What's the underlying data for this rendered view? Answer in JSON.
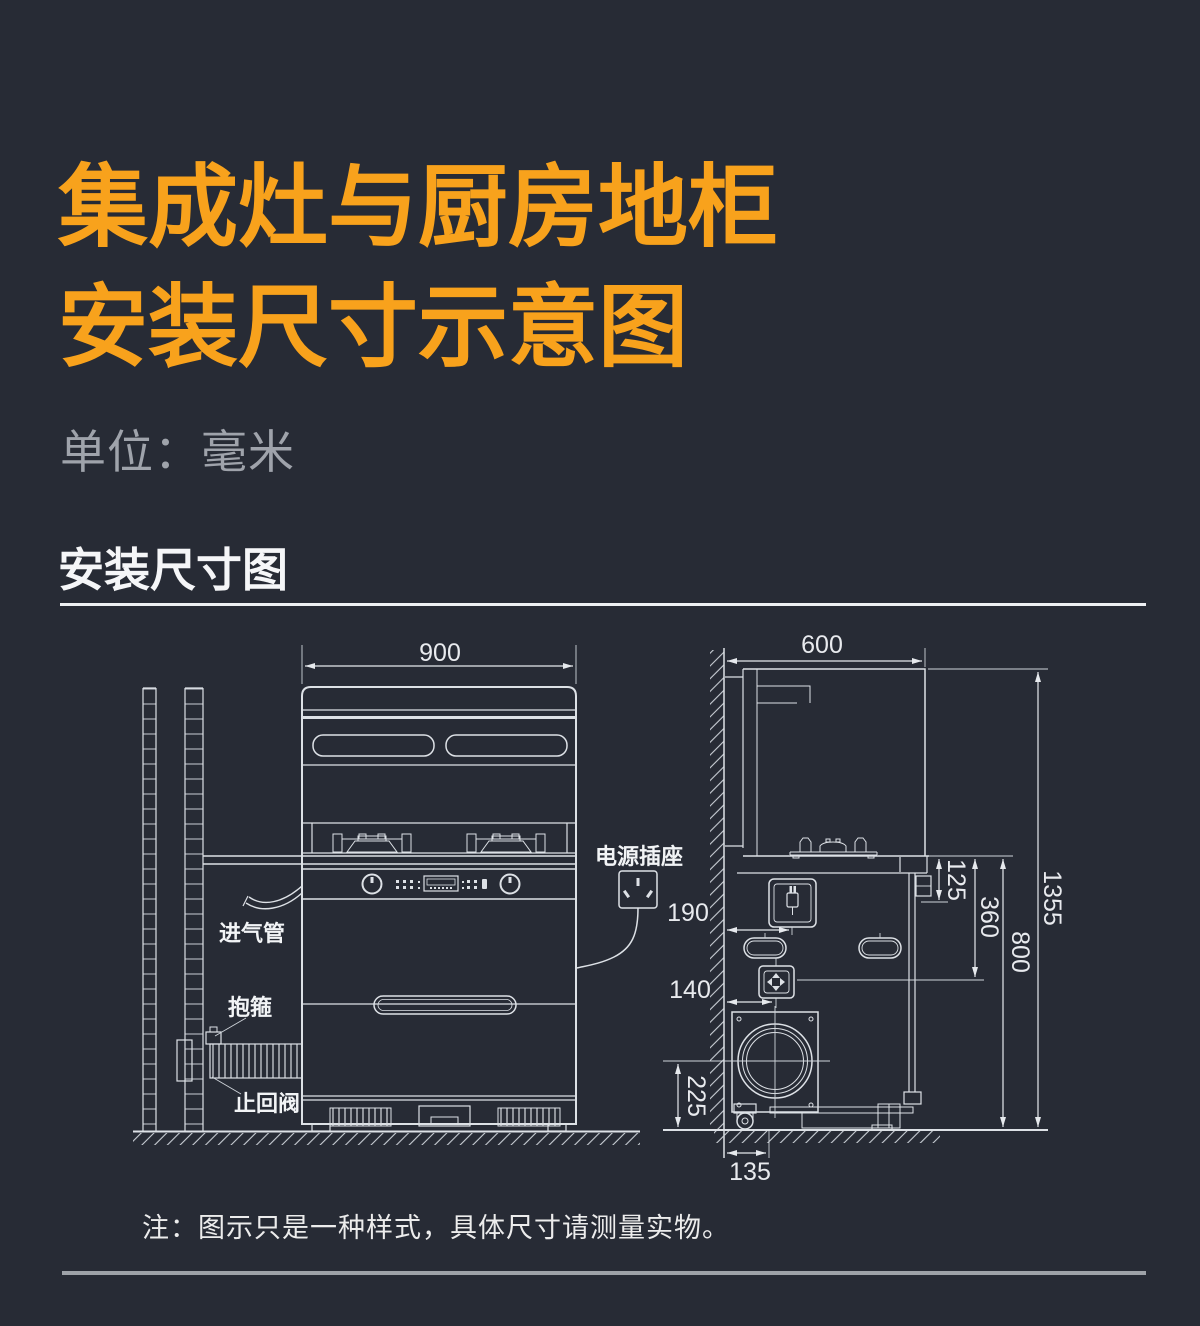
{
  "header": {
    "title_line1": "集成灶与厨房地柜",
    "title_line2": "安装尺寸示意图",
    "unit": "单位：毫米",
    "section": "安装尺寸图"
  },
  "note": "注：图示只是一种样式，具体尺寸请测量实物。",
  "labels": {
    "power_socket": "电源插座",
    "intake_pipe": "进气管",
    "clamp": "抱箍",
    "check_valve": "止回阀"
  },
  "dims": {
    "front_width": "900",
    "depth": "600",
    "socket_from_wall": "190",
    "valve_from_wall": "140",
    "outlet_center_height": "225",
    "outlet_from_wall": "135",
    "socket_below_counter": "125",
    "valve_below_counter": "360",
    "counter_height": "800",
    "total_height": "1355"
  },
  "colors": {
    "accent_orange": "#f8a21c",
    "background": "#272b35",
    "line_white": "#e6e9ed",
    "muted_gray": "#9fa3ab"
  }
}
